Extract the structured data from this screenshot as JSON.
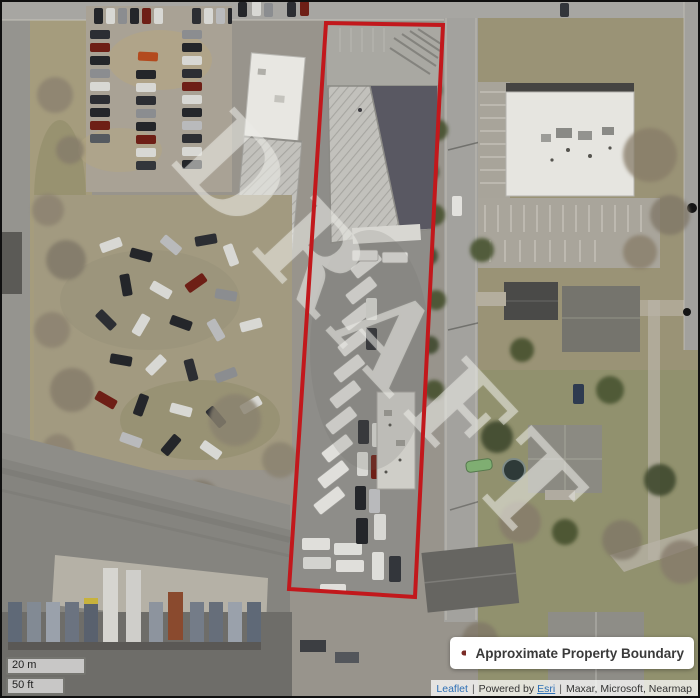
{
  "map": {
    "watermark_text": "DRAFT",
    "boundary_color": "#c2181c"
  },
  "legend": {
    "label": "Approximate Property Boundary",
    "swatch_color": "#7a2b26"
  },
  "scale": {
    "metric_label": "20 m",
    "imperial_label": "50 ft"
  },
  "attribution": {
    "leaflet_link": "Leaflet",
    "separator": "|",
    "powered_by_text": "Powered by",
    "esri_link": "Esri",
    "sources_text": "Maxar, Microsoft, Nearmap"
  }
}
